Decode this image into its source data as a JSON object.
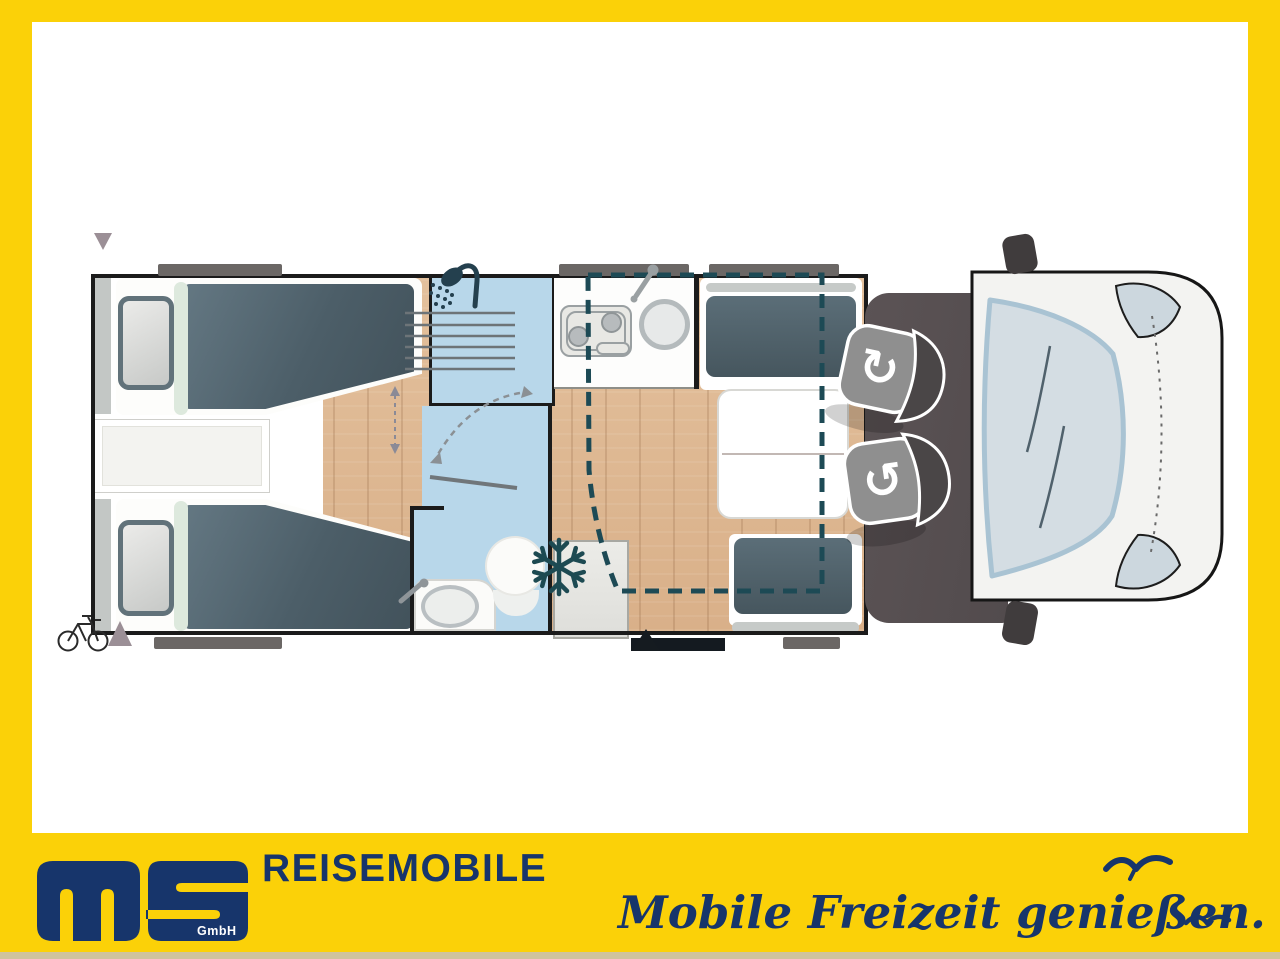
{
  "branding": {
    "logo_text": "ms",
    "logo_gmbh": "GmbH",
    "wordmark": "REISEMOBILE",
    "slogan": "Mobile Freizeit genießen.",
    "colors": {
      "yellow": "#FBD108",
      "navy": "#17356B",
      "footer_strip_tan": "#CFC39D"
    }
  },
  "floorplan": {
    "view": "motorhome top-view layout drawing",
    "rooms": [
      {
        "name": "twin-single-beds",
        "position": "rear-left",
        "features": [
          "two pillows",
          "slate duvets",
          "center chest between beds"
        ]
      },
      {
        "name": "shower-cabin",
        "position": "center-top",
        "icon": "shower-icon"
      },
      {
        "name": "washroom",
        "position": "center-bottom",
        "features": [
          "toilet",
          "vanity-basin",
          "door-swing-arc"
        ]
      },
      {
        "name": "kitchen",
        "position": "center-top",
        "features": [
          "two-burner-hob",
          "round-sink",
          "window"
        ]
      },
      {
        "name": "refrigerator",
        "position": "center-bottom",
        "icon": "snowflake-icon"
      },
      {
        "name": "dinette",
        "position": "front-of-habitation",
        "features": [
          "two-bench-seats",
          "table",
          "drop-down-bed-dashed-outline"
        ]
      },
      {
        "name": "cab",
        "position": "front",
        "features": [
          "two-swivel-seats",
          "windshield",
          "mirrors",
          "headlights"
        ]
      }
    ],
    "markers": [
      "rear-roof-vent-arrow-down",
      "rear-bottom-arrow-up",
      "bicycle-rack-icon",
      "entrance-door-black-bar",
      "entrance-arrow-up",
      "five-window-bars"
    ],
    "colors": {
      "floor_wood": "#DDB794",
      "bathroom_blue": "#B8D7EA",
      "bed_fabric": "#52666F",
      "cab_floor": "#575052",
      "vehicle_body": "#F3F3F1",
      "window_bar_gray": "#6B6765",
      "marker_mauve": "#9B8F96",
      "drop_bed_dashed_teal": "#1D4A55"
    }
  }
}
